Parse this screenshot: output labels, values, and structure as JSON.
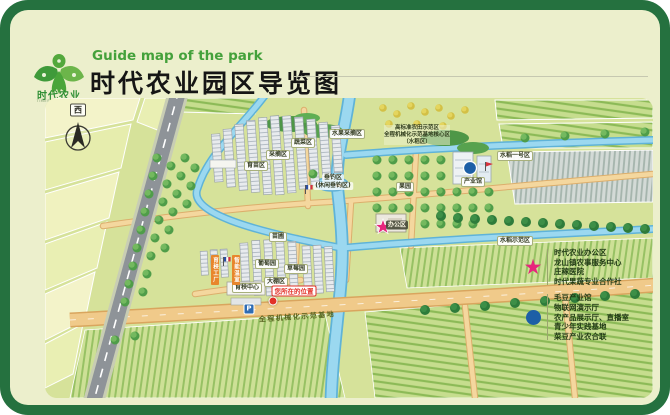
{
  "header": {
    "title_en": "Guide map of the park",
    "title_cn": "时代农业园区导览图",
    "logo_name": "时代农业",
    "logo_sub": "TIMES AGRICULTURE"
  },
  "compass": {
    "direction_label": "西"
  },
  "map": {
    "you_are_here": "您所在的位置",
    "road_label": "全程机械化示范基地",
    "parking_label": "P",
    "area_labels": {
      "vegetable": "蔬菜区",
      "picking": "采摘区",
      "seedling": "育苗区",
      "fruit_picking": "水果采摘区",
      "orchard": "果园",
      "paddy_no1": "水稻一号区",
      "paddy_demo": "水稻示范区",
      "nursery": "苗圃",
      "grape": "葡萄园",
      "strawberry": "草莓园",
      "greenhouse": "大棚区",
      "seedling_center": "育秧中心",
      "industry_hall": "产业馆",
      "office": "办公区",
      "fishing": "垂钓区",
      "fishing_sub": "(休闲垂钓区)",
      "greenhouse_tag1": "育秧工厂",
      "greenhouse_tag2": "智能温室"
    },
    "field_note": {
      "line1": "高标准农田示范区",
      "line2": "全程机械化示范基地核心区",
      "line3": "（水稻区）"
    }
  },
  "legend": {
    "star_color": "#e6257c",
    "dot_color": "#1d5fa6",
    "star_items": [
      "时代农业办公区",
      "龙山镇农事服务中心",
      "庄稼医院",
      "时代果蔬专业合作社"
    ],
    "dot_items": [
      "毛豆产业馆",
      "物联网演示厅",
      "农产品展示厅、直播室",
      "青少年实践基地",
      "菜豆产业农合联"
    ]
  },
  "colors": {
    "frame_green": "#25713f",
    "card_cream": "#ecefcc",
    "map_green": "#d6e29a",
    "title_green": "#44a13b",
    "star_pink": "#e6257c",
    "marker_blue": "#1d5fa6",
    "river_blue": "#9bd8f0",
    "road_gray": "#8e9398",
    "path_tan": "#f0ca8a"
  }
}
